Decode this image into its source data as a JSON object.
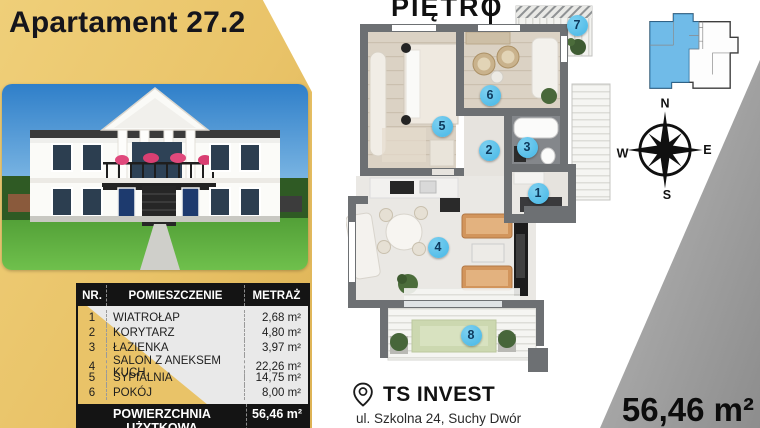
{
  "header": {
    "title": "Apartament 27.2"
  },
  "floor_plan": {
    "label": "PIĘTRO",
    "markers": [
      {
        "n": "1",
        "x": 538,
        "y": 193
      },
      {
        "n": "2",
        "x": 489,
        "y": 150
      },
      {
        "n": "3",
        "x": 527,
        "y": 147
      },
      {
        "n": "4",
        "x": 438,
        "y": 247
      },
      {
        "n": "5",
        "x": 442,
        "y": 126
      },
      {
        "n": "6",
        "x": 490,
        "y": 95
      },
      {
        "n": "7",
        "x": 577,
        "y": 25
      },
      {
        "n": "8",
        "x": 471,
        "y": 335
      }
    ]
  },
  "rooms_table": {
    "headers": {
      "nr": "NR.",
      "room": "POMIESZCZENIE",
      "area": "METRAŻ"
    },
    "rows": [
      {
        "nr": "1",
        "room": "WIATROŁAP",
        "area": "2,68 m²"
      },
      {
        "nr": "2",
        "room": "KORYTARZ",
        "area": "4,80 m²"
      },
      {
        "nr": "3",
        "room": "ŁAZIENKA",
        "area": "3,97 m²"
      },
      {
        "nr": "4",
        "room": "SALON Z ANEKSEM KUCH.",
        "area": "22,26 m²"
      },
      {
        "nr": "5",
        "room": "SYPIALNIA",
        "area": "14,75 m²"
      },
      {
        "nr": "6",
        "room": "POKÓJ",
        "area": "8,00 m²"
      }
    ],
    "footer": {
      "label": "POWIERZCHNIA UŻYTKOWA",
      "value": "56,46 m²"
    }
  },
  "total_area": "56,46 m²",
  "developer": {
    "name": "TS INVEST",
    "address": "ul. Szkolna 24, Suchy Dwór"
  },
  "compass": {
    "north": "N",
    "east": "E",
    "south": "S",
    "west": "W"
  },
  "colors": {
    "gold": "#e9c368",
    "gold_light": "#efcf79",
    "badge_blue": "#55bee9",
    "wall_gray": "#6d7073",
    "wedge_gray": "#9a9a9a",
    "miniplan_blue": "#64b5e6",
    "dark": "#141414"
  }
}
